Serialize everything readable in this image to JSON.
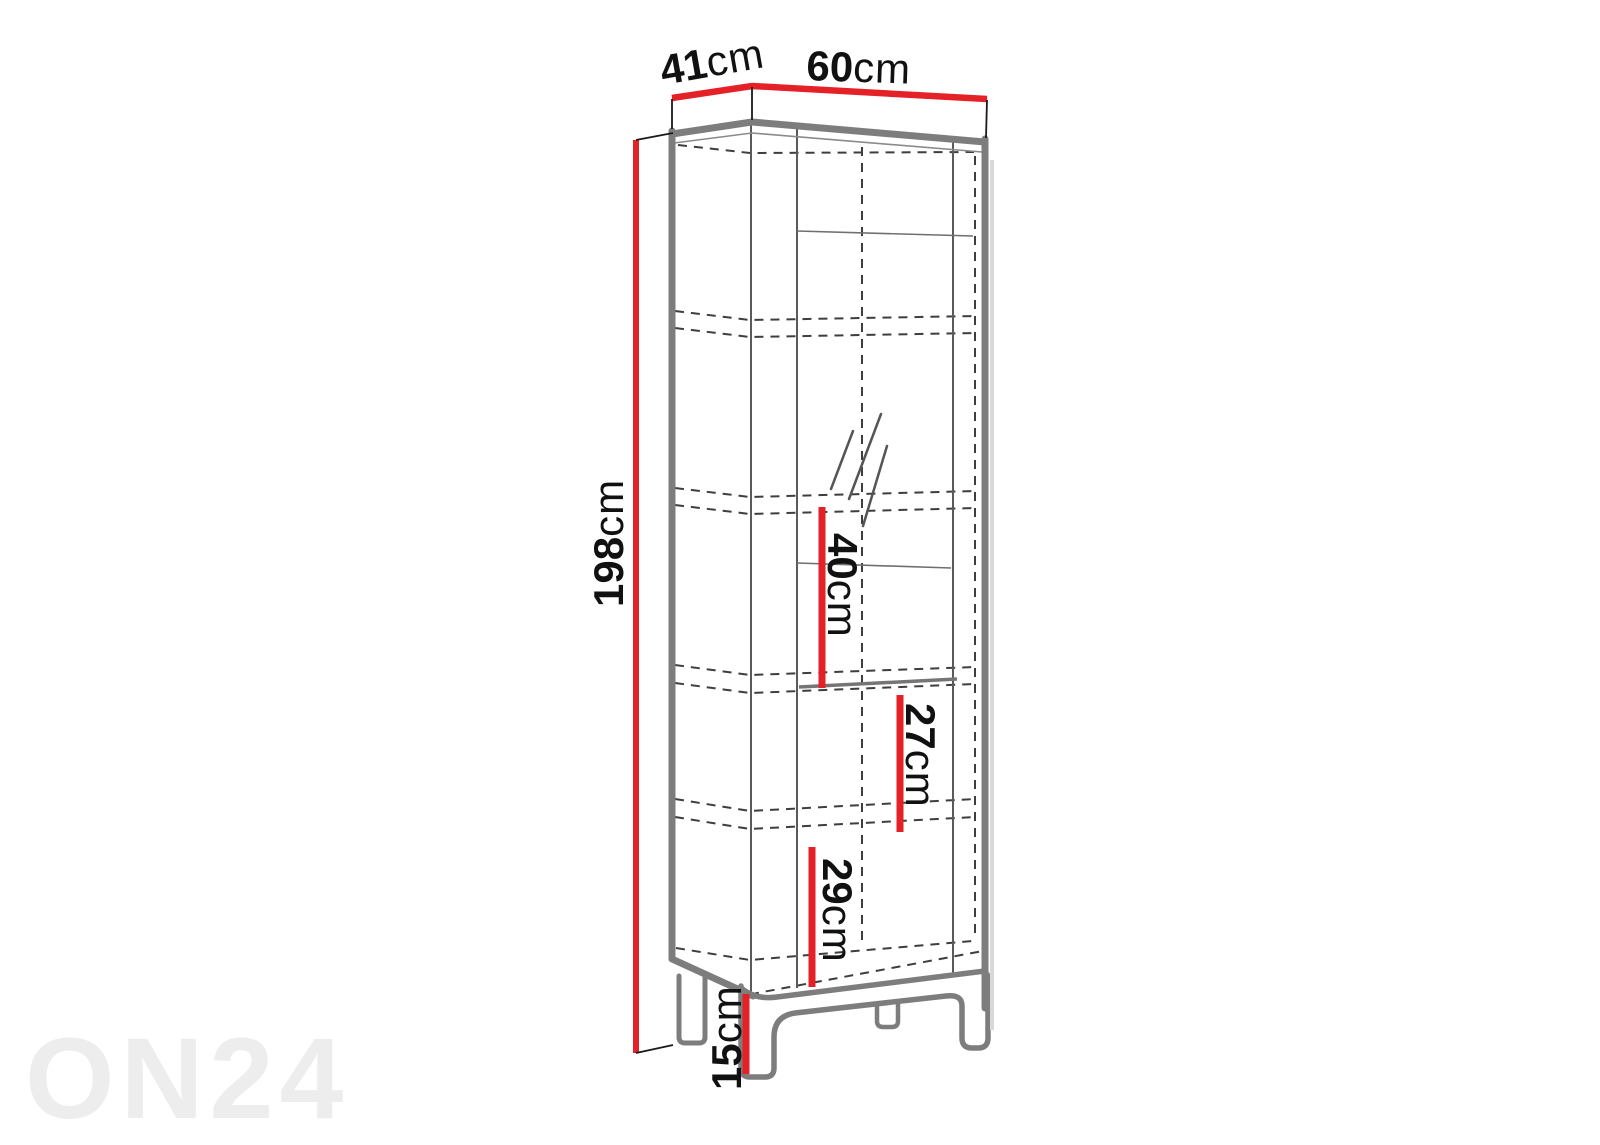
{
  "diagram": {
    "title": "cabinet-dimension-diagram",
    "watermark": "ON24",
    "labels": {
      "depth": {
        "value": "41",
        "unit": "cm"
      },
      "width": {
        "value": "60",
        "unit": "cm"
      },
      "height": {
        "value": "198",
        "unit": "cm"
      },
      "upper_gap": {
        "value": "40",
        "unit": "cm"
      },
      "middle_gap": {
        "value": "27",
        "unit": "cm"
      },
      "lower_gap": {
        "value": "29",
        "unit": "cm"
      },
      "leg_height": {
        "value": "15",
        "unit": "cm"
      }
    },
    "colors": {
      "dimension_red": "#e32127",
      "outline_gray": "#7d7d7d",
      "hidden_line_gray": "#3e3e3e",
      "text_black": "#111111",
      "watermark_gray": "#ededed",
      "background": "#ffffff"
    }
  }
}
